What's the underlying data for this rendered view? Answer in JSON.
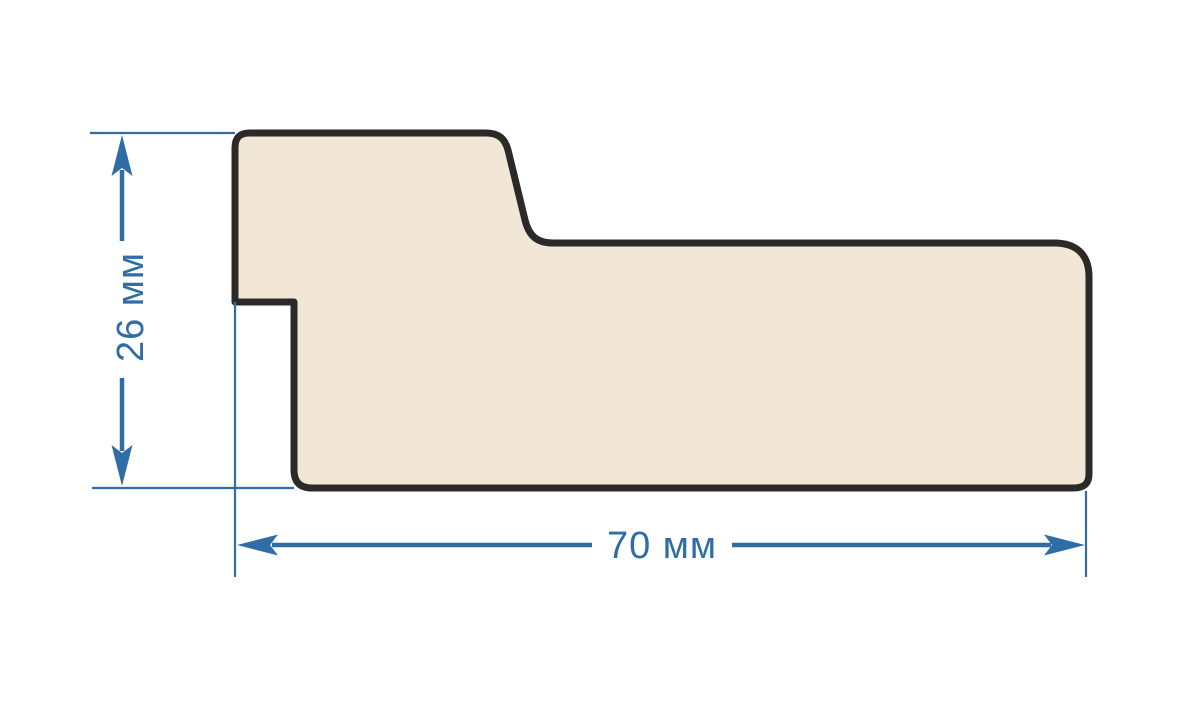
{
  "diagram": {
    "kind": "profile-cross-section-drawing",
    "shape": "stepped wooden moulding profile, side view",
    "dimensions": {
      "height": {
        "label": "26 мм",
        "value": 26,
        "unit": "мм",
        "orientation": "vertical"
      },
      "width": {
        "label": "70 мм",
        "value": 70,
        "unit": "мм",
        "orientation": "horizontal"
      }
    },
    "colors": {
      "dimension": "#2f6da5",
      "profile_fill": "#f2e6d7",
      "profile_outline": "#2b2a29",
      "background": "#ffffff"
    }
  }
}
